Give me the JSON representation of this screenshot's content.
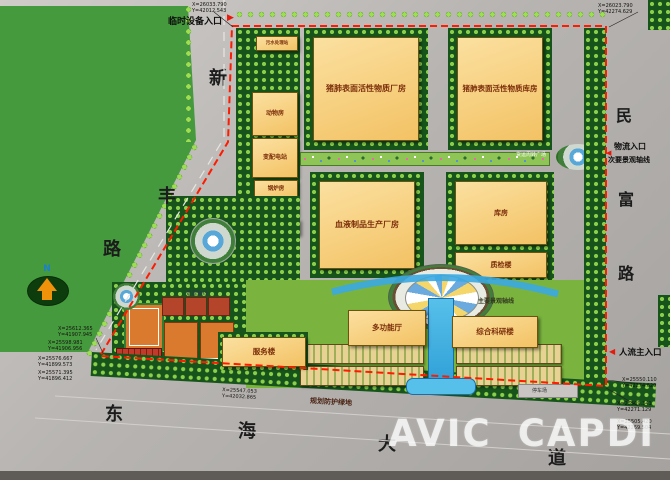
{
  "watermark": {
    "avic": "AVIC",
    "capdi": "CAPDI"
  },
  "compass": {
    "north_label": "N"
  },
  "roads": {
    "xinfeng": {
      "chars": [
        "新",
        "丰",
        "路"
      ]
    },
    "minfu": {
      "chars": [
        "民",
        "富",
        "路"
      ]
    },
    "donghai": {
      "chars": [
        "东",
        "海",
        "大",
        "道"
      ]
    }
  },
  "annotations": {
    "temp_entrance": "临时设备入口",
    "logistics_entrance": "物流入口",
    "secondary_axis": "次要景观轴线",
    "west_axis": "景观轴线",
    "main_axis": "主要景观轴线",
    "pedestrian_entrance": "人流主入口",
    "freight_plaza": "货运周转广场",
    "protective_green": "规划防护绿地",
    "parking": "停车场"
  },
  "buildings": {
    "sewage": "污水处理站",
    "animal": "动物房",
    "substation": "变配电站",
    "boiler": "锅炉房",
    "ethanol": "乙醇库",
    "chemical": "化学药品库",
    "surfactant_factory": "猪肺表面活性物质厂房",
    "surfactant_warehouse": "猪肺表面活性物质库房",
    "blood_factory": "血液制品生产厂房",
    "warehouse": "库房",
    "qc_building": "质检楼",
    "multifunction_hall": "多功能厅",
    "research_building": "综合科研楼",
    "service_building": "服务楼"
  },
  "coordinates": {
    "top_left": {
      "x": "X=26033.790",
      "y": "Y=42012.543"
    },
    "top_right": {
      "x": "X=26023.790",
      "y": "Y=42274.629"
    },
    "bottom_left_1": {
      "x": "X=25612.365",
      "y": "Y=41907.945"
    },
    "bottom_left_2": {
      "x": "X=25598.981",
      "y": "Y=41906.956"
    },
    "bottom_left_3": {
      "x": "X=25576.667",
      "y": "Y=41899.573"
    },
    "bottom_left_4": {
      "x": "X=25571.395",
      "y": "Y=41896.412"
    },
    "bottom_mid": {
      "x": "X=25547.053",
      "y": "Y=42032.865"
    },
    "right_1": {
      "x": "X=25550.110",
      "y": "Y=42274.629"
    },
    "right_2": {
      "x": "X=25509.341",
      "y": "Y=42271.129"
    },
    "right_3": {
      "x": "X=25505.420",
      "y": "Y=42269.504"
    }
  },
  "colors": {
    "field_green": "#459a3e",
    "grove_green": "#17541b",
    "tree_light": "#9ede52",
    "road_grey": "#b7b4b1",
    "building_fill": "#f8d184",
    "boundary_red": "#ff1a00",
    "water_blue": "#3aa9e2"
  }
}
